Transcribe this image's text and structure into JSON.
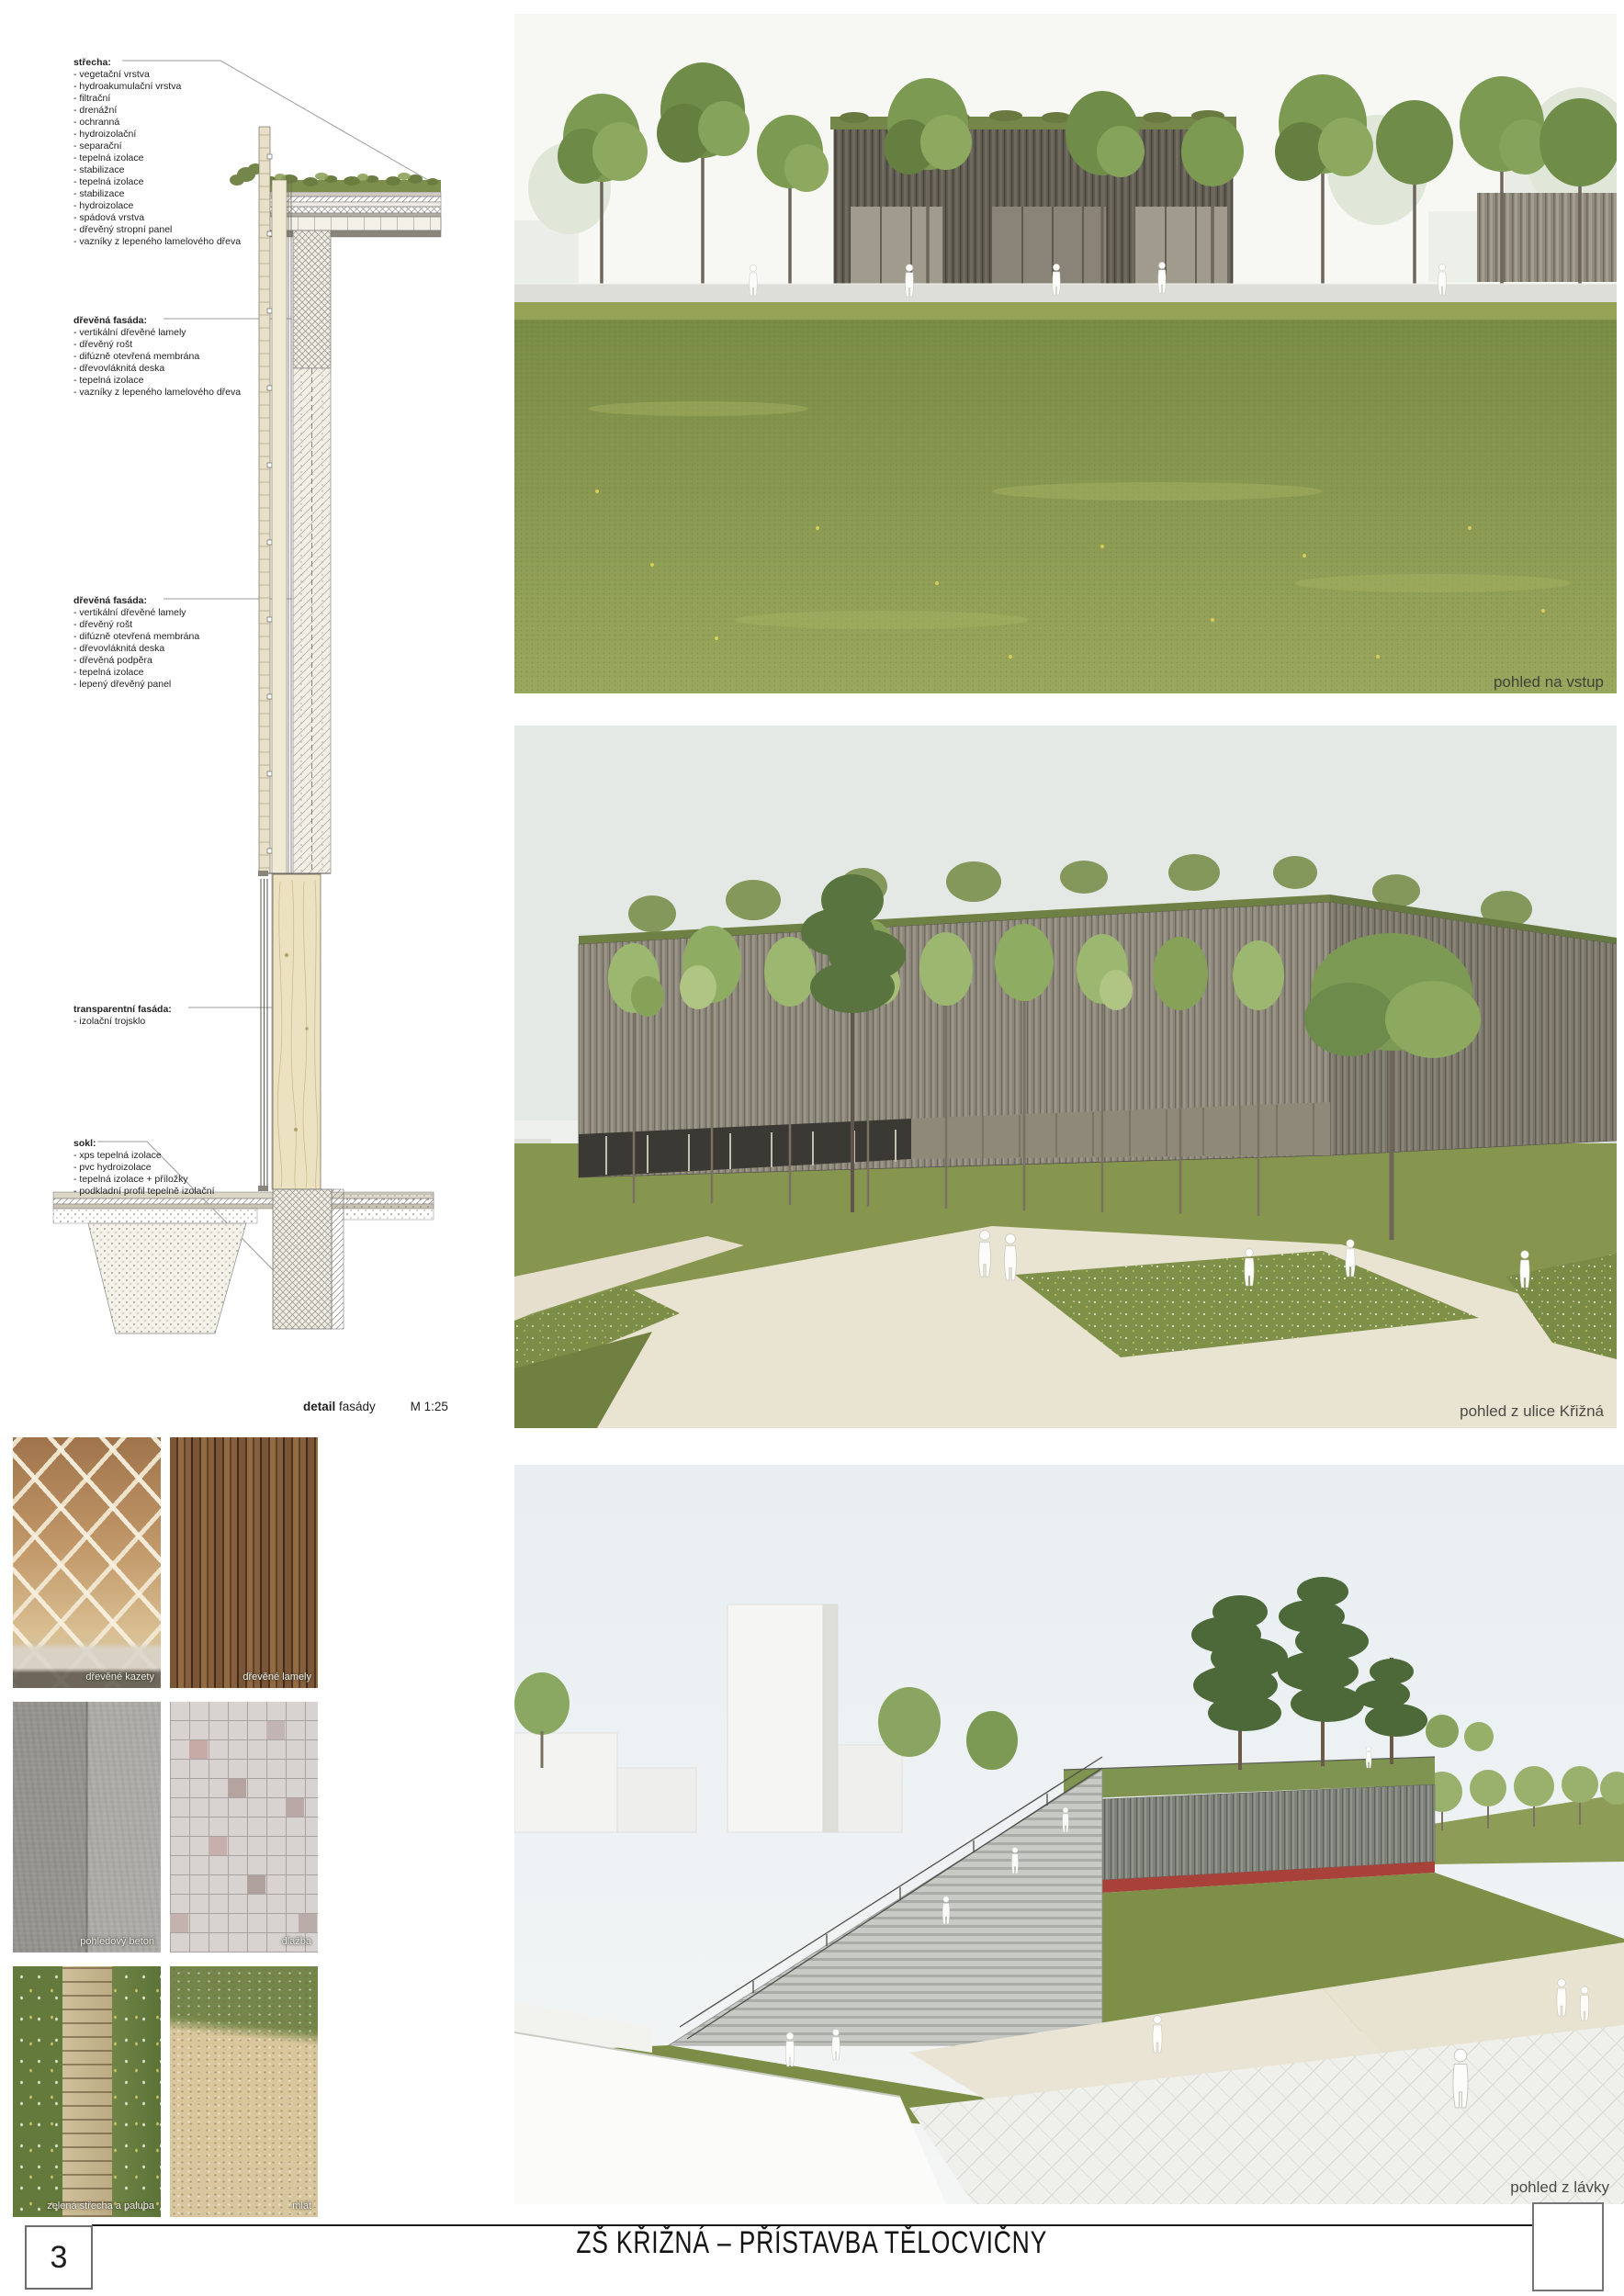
{
  "page": {
    "number": "3",
    "title": "ZŠ KŘIŽNÁ – PŘÍSTAVBA TĚLOCVIČNY"
  },
  "detail_drawing": {
    "caption": {
      "bold": "detail",
      "normal": "fasády",
      "scale": "M 1:25"
    },
    "annotations": [
      {
        "title": "střecha:",
        "items": [
          "- vegetační vrstva",
          "- hydroakumulační vrstva",
          "- filtrační",
          "- drenážní",
          "- ochranná",
          "- hydroizolační",
          "- separační",
          "- tepelná izolace",
          "- stabilizace",
          "- tepelná izolace",
          "- stabilizace",
          "- hydroizolace",
          "- spádová vrstva",
          "- dřevěný stropní panel",
          "- vazníky z lepeného lamelového dřeva"
        ]
      },
      {
        "title": "dřevěná fasáda:",
        "items": [
          "- vertikální dřevěné lamely",
          "- dřevěný rošt",
          "- difúzně otevřená membrána",
          "- dřevovláknitá deska",
          "- tepelná izolace",
          "- vazníky z lepeného lamelového dřeva"
        ]
      },
      {
        "title": "dřevěná fasáda:",
        "items": [
          "- vertikální dřevěné lamely",
          "- dřevěný rošt",
          "- difúzně otevřená membrána",
          "- dřevovláknitá deska",
          "- dřevěná podpěra",
          "- tepelná izolace",
          "- lepený dřevěný panel"
        ]
      },
      {
        "title": "transparentní fasáda:",
        "items": [
          "- izolační trojsklo"
        ]
      },
      {
        "title": "sokl:",
        "items": [
          "- xps tepelná izolace",
          "- pvc hydroizolace",
          "- tepelná izolace + příložky",
          "- podkladní profil tepelně izolační"
        ]
      }
    ]
  },
  "renderings": [
    {
      "caption": "pohled na vstup"
    },
    {
      "caption": "pohled z ulice Křižná"
    },
    {
      "caption": "pohled z lávky"
    }
  ],
  "materials": [
    {
      "label": "dřevěné kazety"
    },
    {
      "label": "dřevěné lamely"
    },
    {
      "label": "pohledový beton"
    },
    {
      "label": "dlažba"
    },
    {
      "label": "zelená střecha a paluba"
    },
    {
      "label": "mlat"
    }
  ],
  "colors": {
    "lawn_green": "#7e9148",
    "facade_dark": "#5d594f",
    "facade_gray": "#8b867b",
    "path_beige": "#e9e3d2",
    "track_red": "#a7413a",
    "sky_tint": "#e3e8e5"
  }
}
